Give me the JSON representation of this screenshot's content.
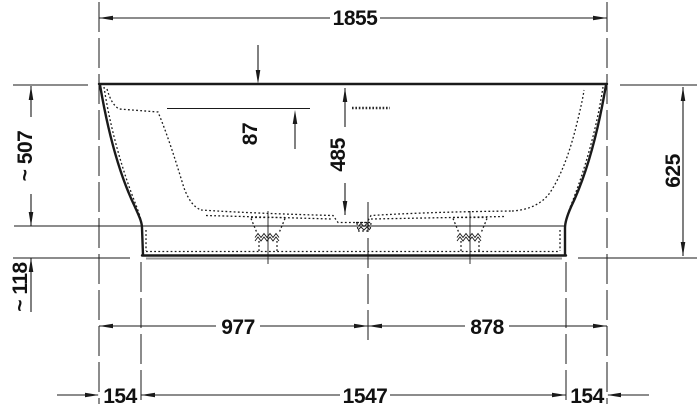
{
  "drawing": {
    "labels": {
      "overall_width": "1855",
      "rim_to_base_top": "~ 507",
      "base_height": "~ 118",
      "rim_to_inner_ledge": "87",
      "inner_depth": "485",
      "overall_height": "625",
      "left_rim_to_drain": "977",
      "drain_to_right_rim": "878",
      "left_base_inset": "154",
      "base_length": "1547",
      "right_base_inset": "154"
    },
    "colors": {
      "line": "#1a1a1a",
      "base_shadow": "#999999",
      "background": "#ffffff"
    }
  }
}
